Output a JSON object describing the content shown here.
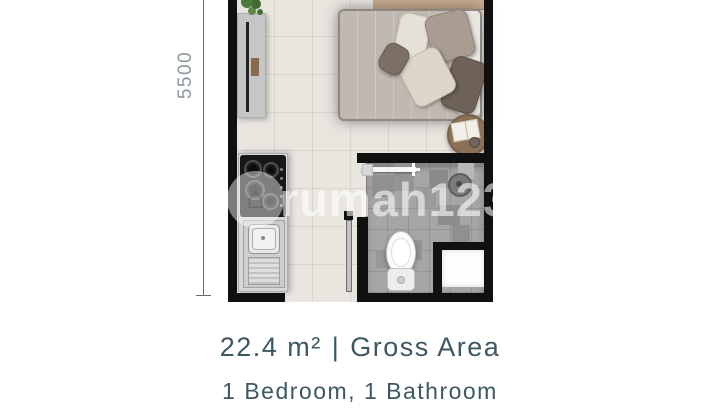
{
  "dimension": {
    "label": "5500"
  },
  "watermark": {
    "text": "rumah123",
    "house_icon": "⌂"
  },
  "footer": {
    "area_value": "22.4 m²",
    "separator": "|",
    "area_label": "Gross Area",
    "rooms_line": "1 Bedroom, 1 Bathroom"
  },
  "colors": {
    "text_primary": "#3d5763",
    "dimension_text": "#8f989e",
    "wall": "#101010",
    "bedroom_floor": "#e9e6e0",
    "bathroom_floor": "#a6a6a6",
    "watermark": "rgba(255,255,255,0.58)"
  }
}
